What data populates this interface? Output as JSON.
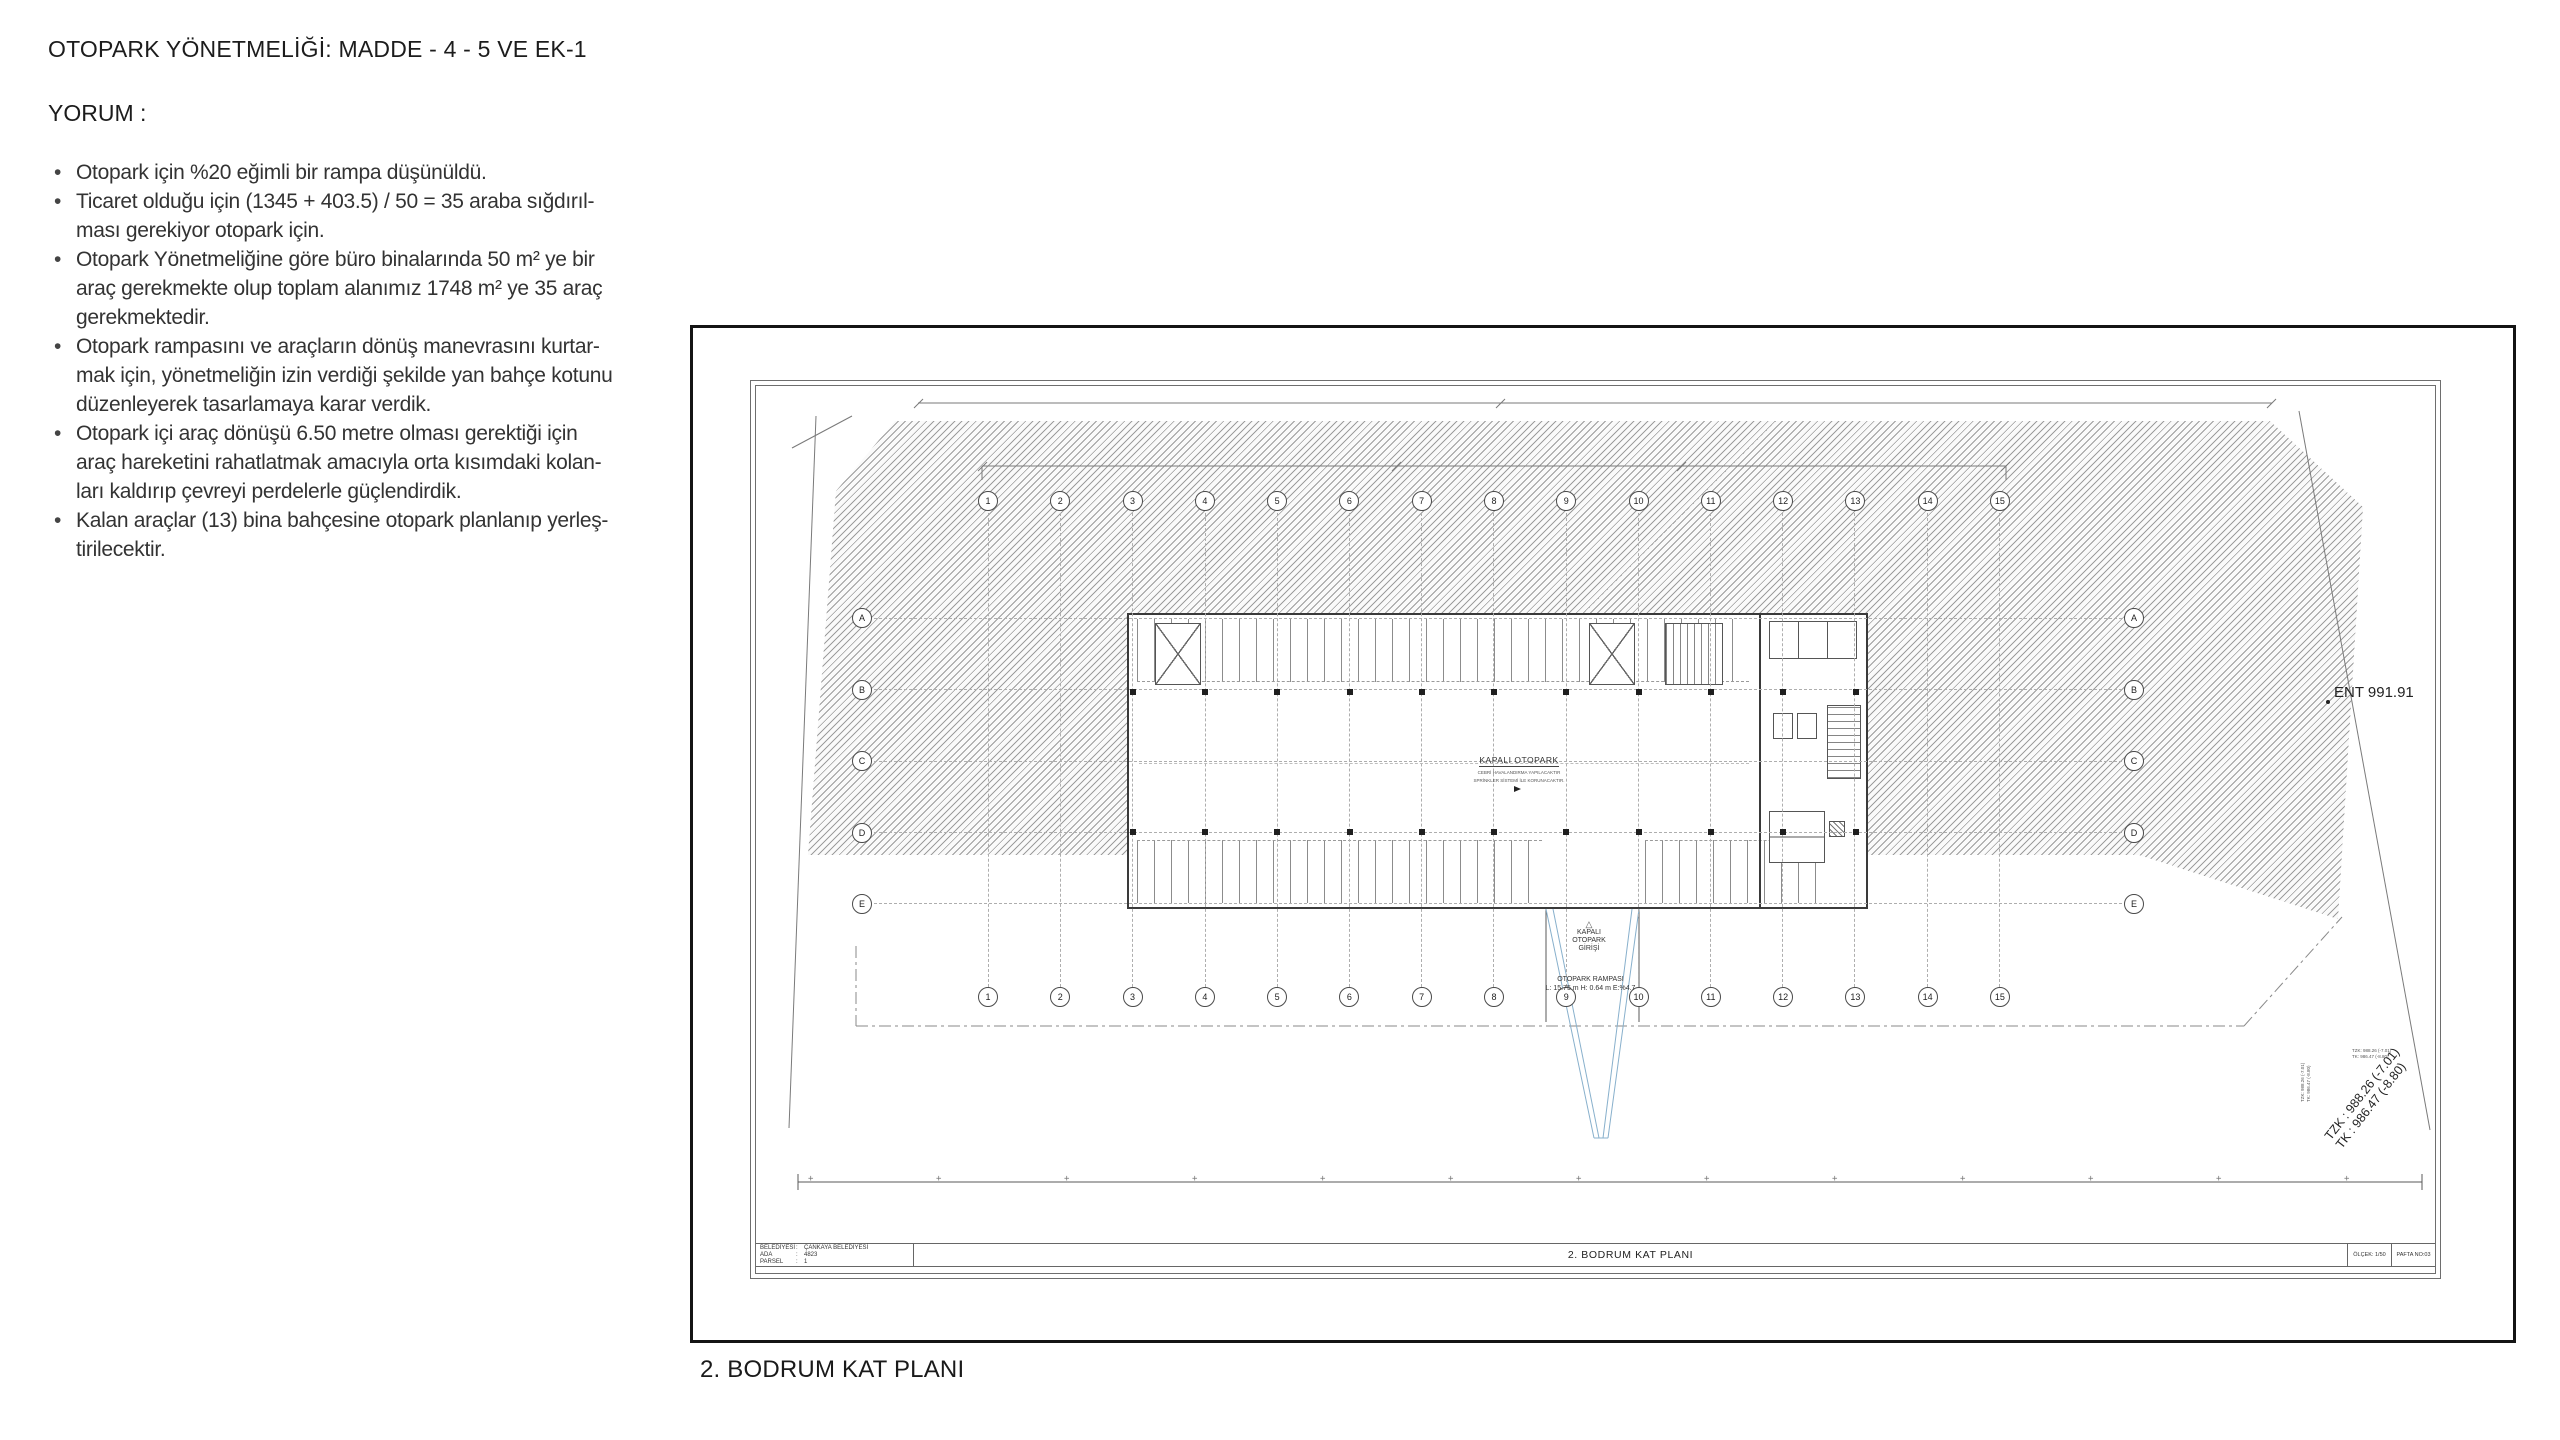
{
  "content": {
    "title": "OTOPARK YÖNETMELİĞİ: MADDE - 4 - 5 VE EK-1",
    "yorum_label": "YORUM :",
    "bullet_glyph": "•",
    "bullets": [
      {
        "lines": [
          "Otopark için %20 eğimli bir rampa düşünüldü."
        ]
      },
      {
        "lines": [
          "Ticaret olduğu için (1345 + 403.5) / 50 = 35 araba sığdırıl-",
          "ması gerekiyor otopark için."
        ]
      },
      {
        "lines": [
          "Otopark Yönetmeliğine göre büro binalarında 50 m² ye bir",
          "araç gerekmekte olup toplam alanımız 1748 m² ye 35 araç",
          "gerekmektedir."
        ]
      },
      {
        "lines": [
          "Otopark rampasını ve araçların dönüş manevrasını kurtar-",
          "mak için, yönetmeliğin izin verdiği şekilde yan bahçe kotunu",
          "düzenleyerek tasarlamaya karar verdik."
        ]
      },
      {
        "lines": [
          "Otopark içi araç dönüşü 6.50 metre olması gerektiği için",
          "araç hareketini rahatlatmak amacıyla orta kısımdaki kolan-",
          "ları kaldırıp çevreyi perdelerle güçlendirdik."
        ]
      },
      {
        "lines": [
          "Kalan araçlar (13) bina bahçesine otopark planlanıp yerleş-",
          "tirilecektir."
        ]
      }
    ],
    "caption": "2. BODRUM KAT PLANI"
  },
  "drawing": {
    "grid": {
      "columns": [
        "1",
        "2",
        "3",
        "4",
        "5",
        "6",
        "7",
        "8",
        "9",
        "10",
        "11",
        "12",
        "13",
        "14",
        "15"
      ],
      "rows": [
        "A",
        "B",
        "C",
        "D",
        "E"
      ]
    },
    "plan": {
      "kapali": "KAPALI OTOPARK",
      "note1": "CEBRİ HAVALANDIRMA YAPILACAKTIR",
      "note2": "SPRİNKLER SİSTEMİ İLE KORUNACAKTIR.",
      "triangle_icon": "△",
      "giris_lines": [
        "KAPALI",
        "OTOPARK",
        "GİRİŞİ"
      ],
      "rampa_line1": "OTOPARK RAMPASI",
      "rampa_line2": "L: 15.75 m  H: 0.64 m  E:%4.7"
    },
    "annotations": {
      "ent": "ENT 991.91",
      "tzk": "TZK : 988.26 (-7.01)",
      "tk": "TK : 986.47 (-8.80)",
      "tzk_small": "TZK: 988.26 (-7.01)",
      "tk_small": "TK: 986.47 (-8.80)"
    },
    "titleblock": {
      "belediyesi_label": "BELEDİYESİ",
      "belediyesi_value": "ÇANKAYA BELEDİYESİ",
      "ada_label": "ADA",
      "ada_value": "4823",
      "parsel_label": "PARSEL",
      "parsel_value": "1",
      "plan_title": "2. BODRUM KAT PLANI",
      "olcek": "ÖLÇEK: 1/50",
      "pafta": "PAFTA NO:03"
    }
  }
}
